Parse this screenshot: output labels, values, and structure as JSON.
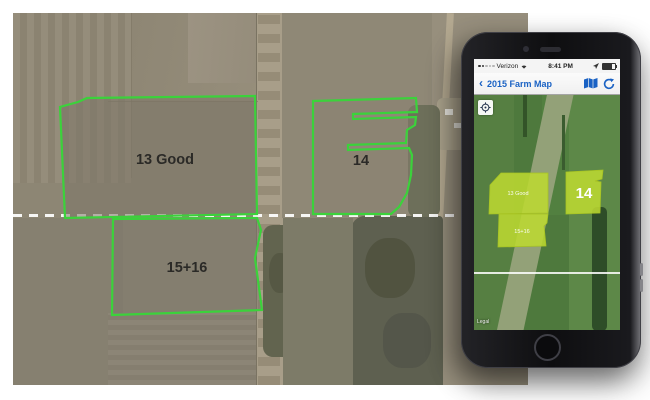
{
  "desktop_map": {
    "fields": [
      {
        "label": "13 Good"
      },
      {
        "label": "14"
      },
      {
        "label": "15+16"
      }
    ]
  },
  "phone": {
    "status": {
      "carrier": "Verizon",
      "time": "8:41 PM"
    },
    "nav": {
      "back_glyph": "‹",
      "title": "2015 Farm Map"
    },
    "map": {
      "fields": [
        {
          "label": "13 Good"
        },
        {
          "label": "15+16"
        },
        {
          "label": "14"
        }
      ],
      "legal": "Legal"
    }
  },
  "colors": {
    "field_outline": "#3bd23b",
    "field_highlight": "#bcd831",
    "nav_accent": "#1a62c4"
  }
}
